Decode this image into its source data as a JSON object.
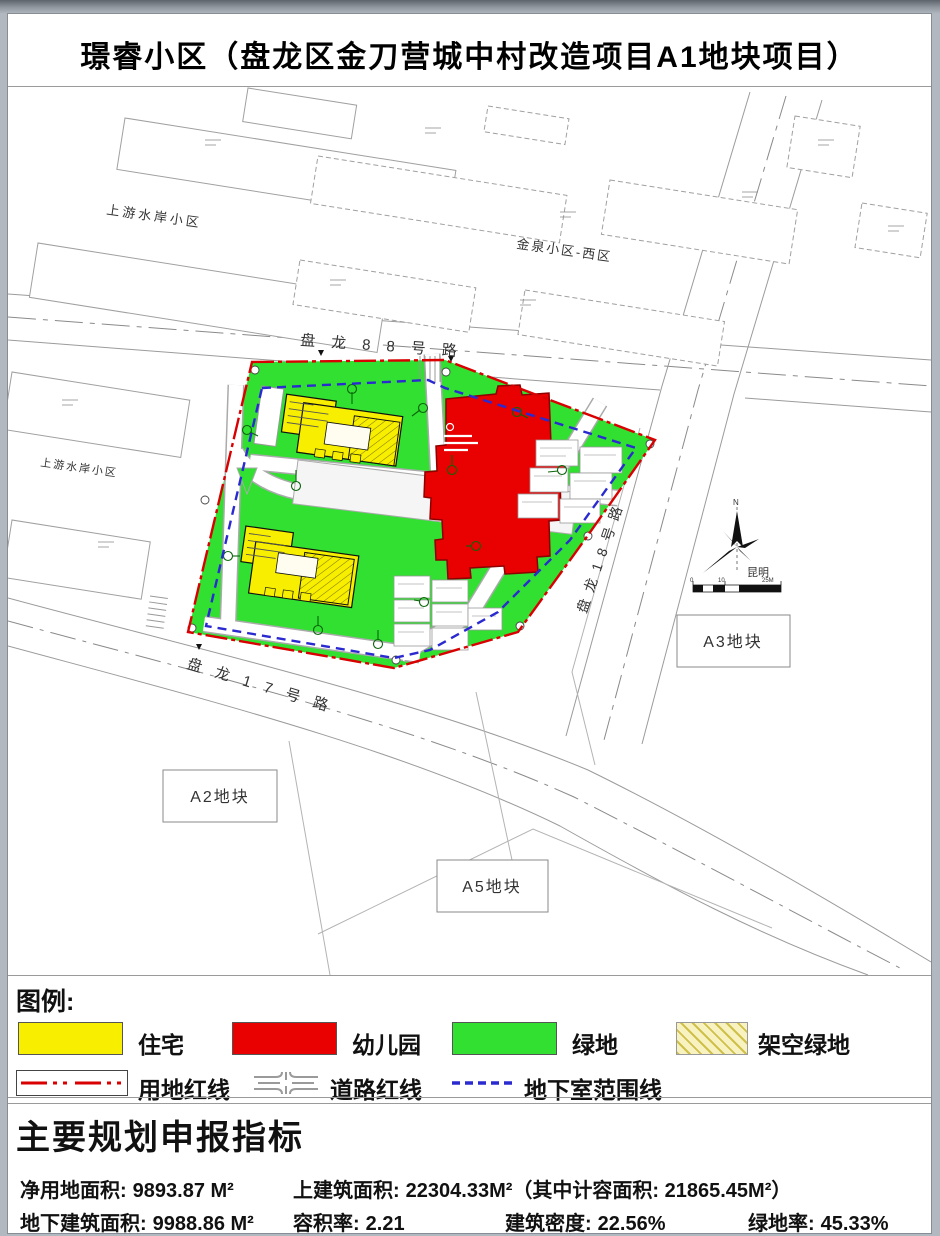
{
  "title": "璟睿小区（盘龙区金刀营城中村改造项目A1地块项目）",
  "map": {
    "roads": {
      "r88": "盘龙88号路",
      "r17": "盘龙17号路",
      "r18": "盘龙18号路"
    },
    "neighborhoods": {
      "upstream": "上游水岸小区",
      "jinquan": "金泉小区-西区"
    },
    "plots": {
      "a2": "A2地块",
      "a3": "A3地块",
      "a5": "A5地块"
    },
    "compass": {
      "north": "N",
      "city": "昆明"
    },
    "scale_ticks": [
      "0",
      "10",
      "25M"
    ]
  },
  "legend": {
    "title": "图例:",
    "areas": [
      {
        "label": "住宅",
        "color": "#f8ef00"
      },
      {
        "label": "幼儿园",
        "color": "#e90000"
      },
      {
        "label": "绿地",
        "color": "#31e031"
      },
      {
        "label": "架空绿地",
        "color": "#f7f2c0"
      }
    ],
    "lines": [
      {
        "label": "用地红线",
        "color": "#d80000"
      },
      {
        "label": "道路红线",
        "color": "#9a9a9a"
      },
      {
        "label": "地下室范围线",
        "color": "#2a2ad0"
      }
    ]
  },
  "indicators": {
    "title": "主要规划申报指标",
    "items": [
      {
        "label": "净用地面积:",
        "value": "9893.87 M²"
      },
      {
        "label": "上建筑面积:",
        "value": "22304.33M²（其中计容面积: 21865.45M²）"
      },
      {
        "label": "地下建筑面积:",
        "value": "9988.86 M²"
      },
      {
        "label": "容积率:",
        "value": "2.21"
      },
      {
        "label": "建筑密度:",
        "value": "22.56%"
      },
      {
        "label": "绿地率:",
        "value": "45.33%"
      }
    ]
  }
}
